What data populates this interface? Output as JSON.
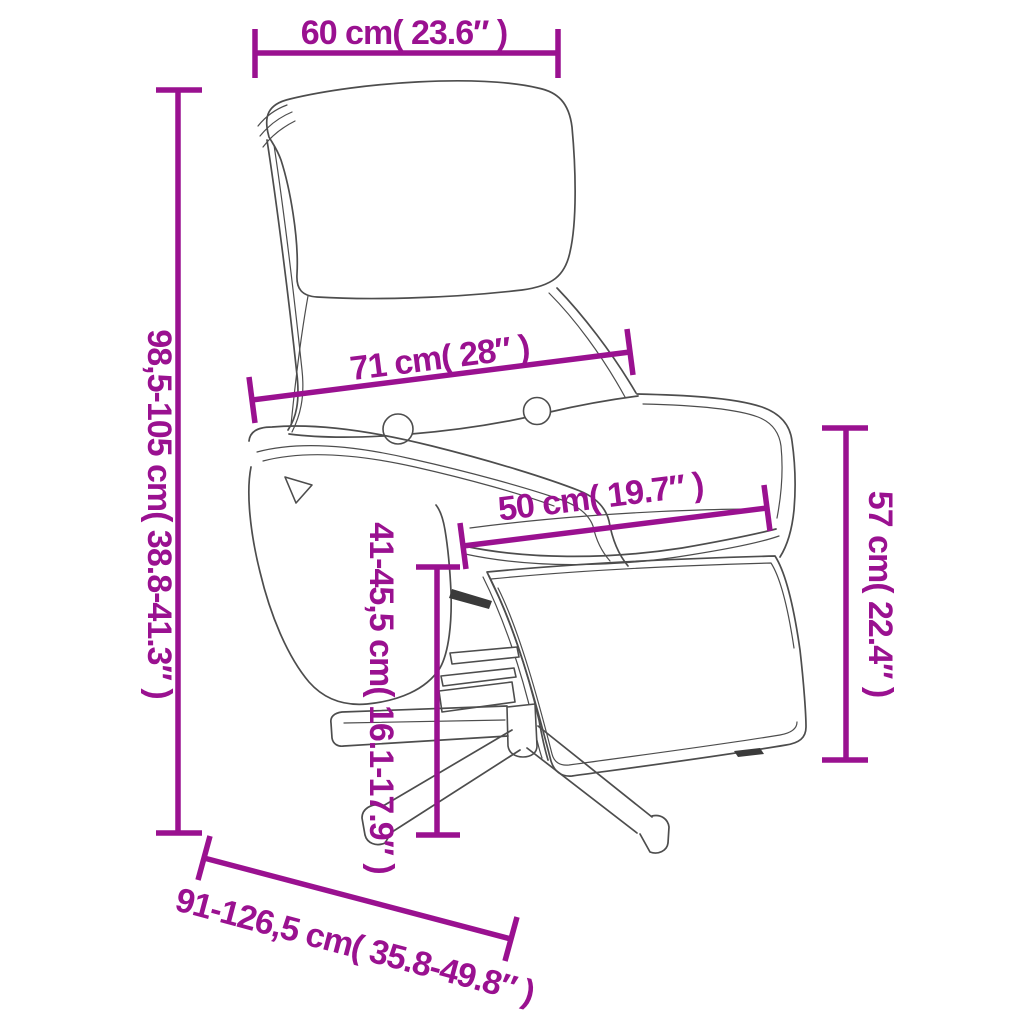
{
  "diagram": {
    "subject": "recliner-chair-with-footrest",
    "view": "three-quarter front line drawing with dimension callouts"
  },
  "colors": {
    "dimension": "#9A1190",
    "outline": "#4D4D4D",
    "dark_detail": "#3A3A3A",
    "background": "#FFFFFF"
  },
  "dims": {
    "top_width": {
      "label": "60 cm( 23.6″ )"
    },
    "total_height": {
      "label": "98,5-105 cm( 38.8-41.3″ )"
    },
    "back_width": {
      "label": "71 cm( 28″ )"
    },
    "seat_width": {
      "label": "50 cm( 19.7″ )"
    },
    "backrest_height": {
      "label": "57 cm( 22.4″ )"
    },
    "seat_height": {
      "label": "41-45,5 cm( 16.1-17.9″ )"
    },
    "depth": {
      "label": "91-126,5 cm( 35.8-49.8″ )"
    }
  }
}
